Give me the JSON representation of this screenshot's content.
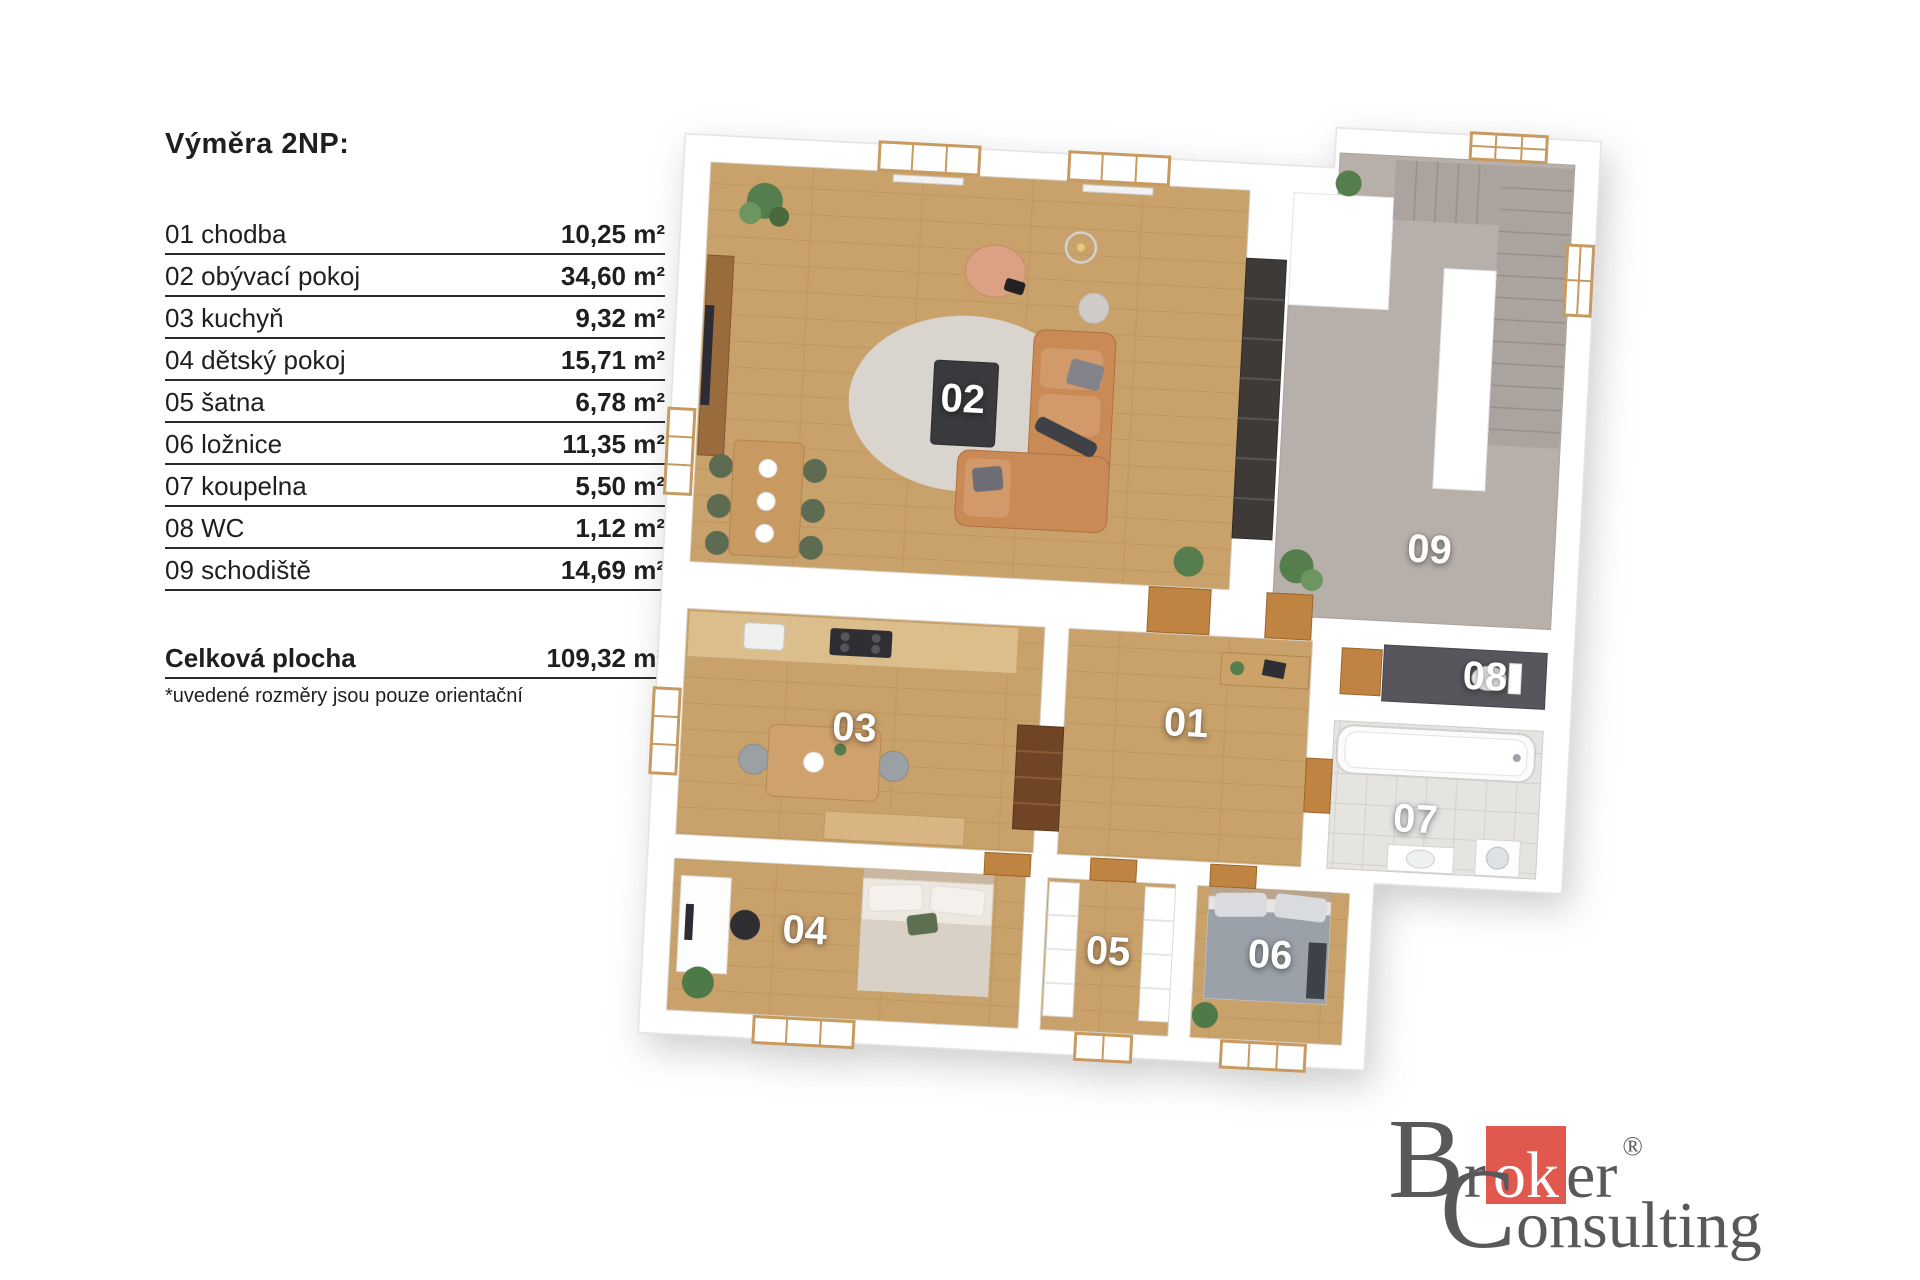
{
  "legend": {
    "title": "Výměra 2NP:",
    "items": [
      {
        "label": "01 chodba",
        "value": "10,25 m²"
      },
      {
        "label": "02 obývací pokoj",
        "value": "34,60 m²"
      },
      {
        "label": "03 kuchyň",
        "value": "9,32 m²"
      },
      {
        "label": "04 dětský pokoj",
        "value": "15,71 m²"
      },
      {
        "label": "05 šatna",
        "value": "6,78 m²"
      },
      {
        "label": "06 ložnice",
        "value": "11,35 m²"
      },
      {
        "label": "07 koupelna",
        "value": "5,50 m²"
      },
      {
        "label": "08 WC",
        "value": "1,12 m²"
      },
      {
        "label": "09 schodiště",
        "value": "14,69 m²"
      }
    ],
    "total": {
      "label": "Celková plocha",
      "value": "109,32 m²"
    },
    "footnote": "*uvedené rozměry jsou pouze orientační"
  },
  "plan": {
    "labels": [
      "01",
      "02",
      "03",
      "04",
      "05",
      "06",
      "07",
      "08",
      "09"
    ],
    "floor_colors": {
      "wood": "#c9a16b",
      "staircase": "#b7b0aa",
      "bath_tile": "#e6e4e1",
      "wc_dark": "#57565c"
    }
  },
  "logo": {
    "b": "B",
    "r": "r",
    "ok": "ok",
    "er": "er",
    "reg": "®",
    "c": "C",
    "onsulting": "onsulting",
    "red": "#e0584e",
    "gray": "#58595b"
  }
}
